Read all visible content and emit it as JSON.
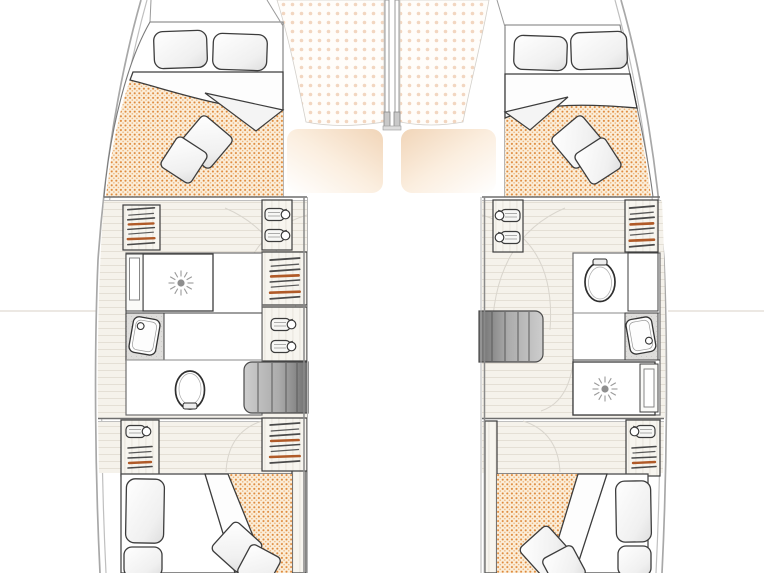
{
  "palette": {
    "hull_line": "#a8a8a8",
    "hull_line_inner": "#bfbfbf",
    "wall_line": "#6e6e6e",
    "furniture_line": "#3c3c3c",
    "arc_line": "#d9d5cd",
    "baseline": "#ece8e3",
    "floor_wood": "#f5f2eb",
    "plank_line": "#e4dfd5",
    "mattress_bg": "#fbeeda",
    "mattress_dot": "#df8a3c",
    "net_bg": "#fffdfa",
    "net_dot": "#f2d6c0",
    "window_glow": "#f1d5b8",
    "steps_dark": "#6e6e6e",
    "steps_light": "#cdcdcd",
    "hanger_accent": "#b05a28",
    "counter_speckle": "#dedddb",
    "drain": "#8f8f8f"
  },
  "icons": {
    "toilet-icon": "oval bowl with lid mark",
    "washbasin-icon": "tilted rounded basin with faucet dot",
    "shower-drain-icon": "starburst drain rosette",
    "hanger-stack-icon": "stacked clothes hangers with rust bars",
    "towel-shelf-icon": "rolled towel with ring",
    "companionway-steps-icon": "grey gradient stair block",
    "berth-pillow-icon": "rounded rectangle pillow",
    "scatter-cushion-icon": "rotated square cushion",
    "trampoline-net-icon": "dotted trapezoid panel",
    "windshield-icon": "rounded rectangle with warm glow",
    "mast-beam-icon": "twin vertical posts"
  },
  "rooms": {
    "port_hull": {
      "forward_cabin": [
        "double-berth",
        "berth-pillows",
        "scatter-cushions"
      ],
      "midship": [
        "hanging-locker",
        "towel-shelves",
        "wardrobe",
        "shower",
        "washbasin",
        "toilet",
        "companionway-steps"
      ],
      "aft_cabin": [
        "hanging-locker",
        "towel-shelf",
        "wardrobe",
        "double-berth",
        "scatter-cushions"
      ]
    },
    "starboard_hull": {
      "forward_cabin": [
        "double-berth",
        "berth-pillows",
        "scatter-cushions"
      ],
      "midship": [
        "towel-shelves",
        "hanging-locker",
        "toilet",
        "washbasin",
        "shower",
        "companionway-steps"
      ],
      "aft_cabin": [
        "towel-shelf",
        "hanging-locker",
        "double-berth",
        "scatter-cushions"
      ]
    },
    "foredeck": [
      "trampoline-net-port",
      "trampoline-net-starboard",
      "mast-beam"
    ],
    "bridgedeck": [
      "windshield-port",
      "windshield-starboard"
    ]
  }
}
